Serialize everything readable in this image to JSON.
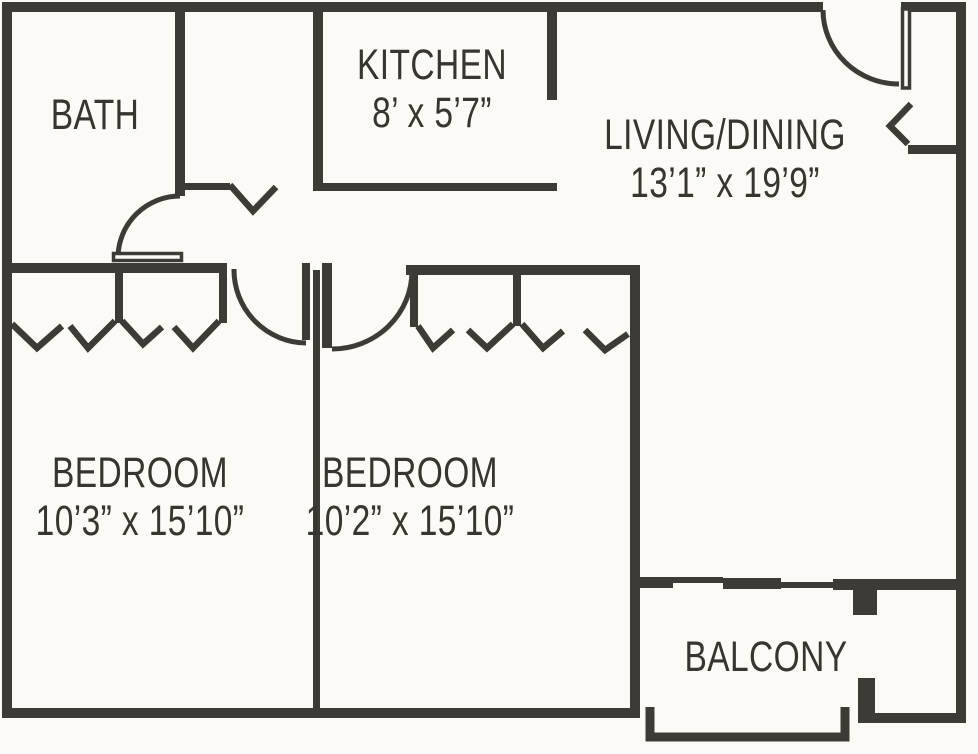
{
  "plan": {
    "rooms": [
      {
        "name": "BATH",
        "dims": ""
      },
      {
        "name": "KITCHEN",
        "dims": "8’ x 5’7”"
      },
      {
        "name": "LIVING/DINING",
        "dims": "13’1” x 19’9”"
      },
      {
        "name": "BEDROOM",
        "dims": "10’3” x 15’10”"
      },
      {
        "name": "BEDROOM",
        "dims": "10’2” x 15’10”"
      },
      {
        "name": "BALCONY",
        "dims": ""
      }
    ]
  },
  "colors": {
    "wall": "#3e3a35",
    "text": "#383430",
    "background": "#fbfaf7"
  }
}
